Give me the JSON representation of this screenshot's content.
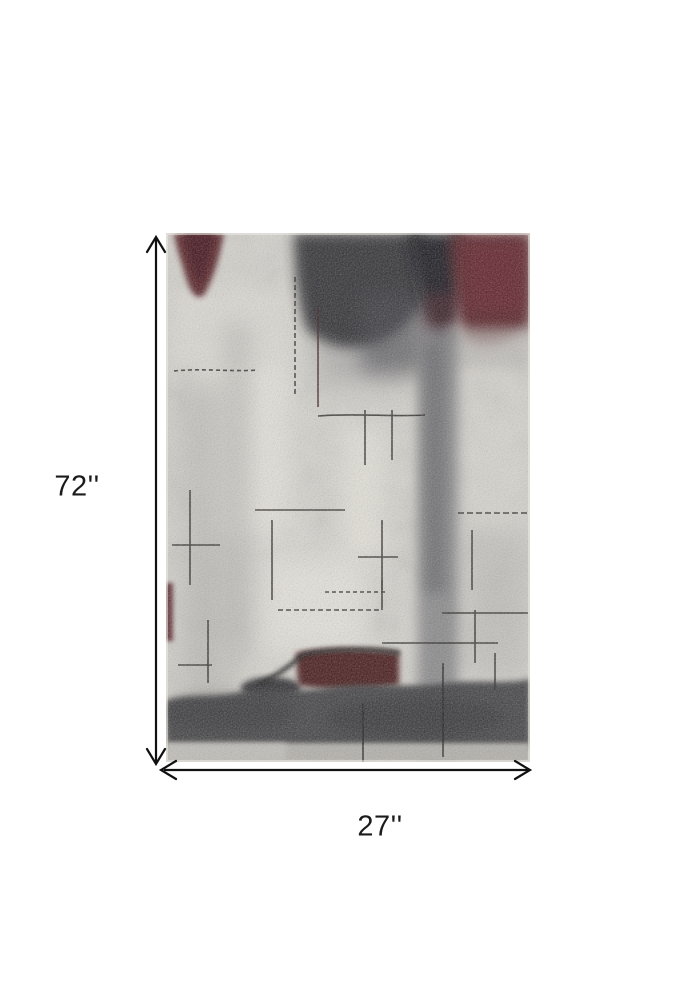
{
  "figure": {
    "height_label": "72''",
    "width_label": "27''",
    "arrow_color": "#111111",
    "label_color": "#1b1b1b",
    "background_color": "#ffffff"
  },
  "rug": {
    "palette": {
      "base": "#d6d3cc",
      "ivory": "#e9e6df",
      "charcoal": "#26262b",
      "black": "#17181c",
      "maroon": "#521a21",
      "dark_red": "#451318",
      "gray_streak": "#77777a",
      "bottom_band": "#3a3a3c",
      "bottom_strip": "#b2afa9",
      "scratch": "#26221f"
    }
  }
}
